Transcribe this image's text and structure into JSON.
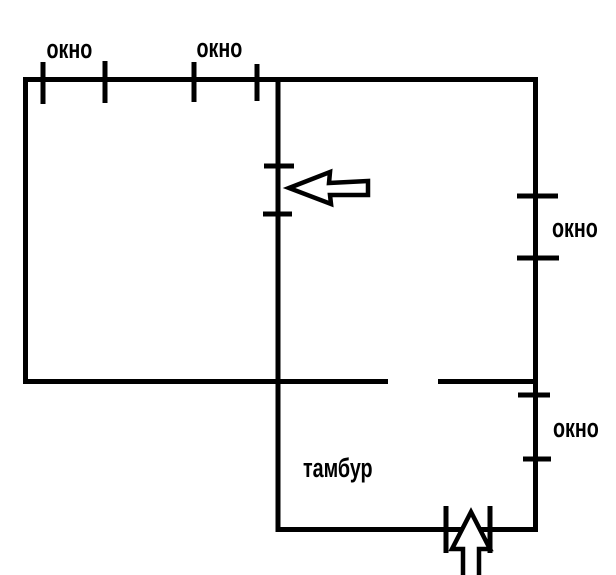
{
  "diagram": {
    "labels": {
      "window_top_1": "окно",
      "window_top_2": "окно",
      "window_right_upper": "окно",
      "window_right_lower": "окно",
      "vestibule": "тамбур"
    },
    "icons": {
      "door_arrow": "left-block-arrow",
      "entrance_arrow": "up-block-arrow"
    },
    "colors": {
      "line": "#000000",
      "text": "#000000",
      "background": "#ffffff",
      "arrow_fill": "#ffffff"
    }
  }
}
